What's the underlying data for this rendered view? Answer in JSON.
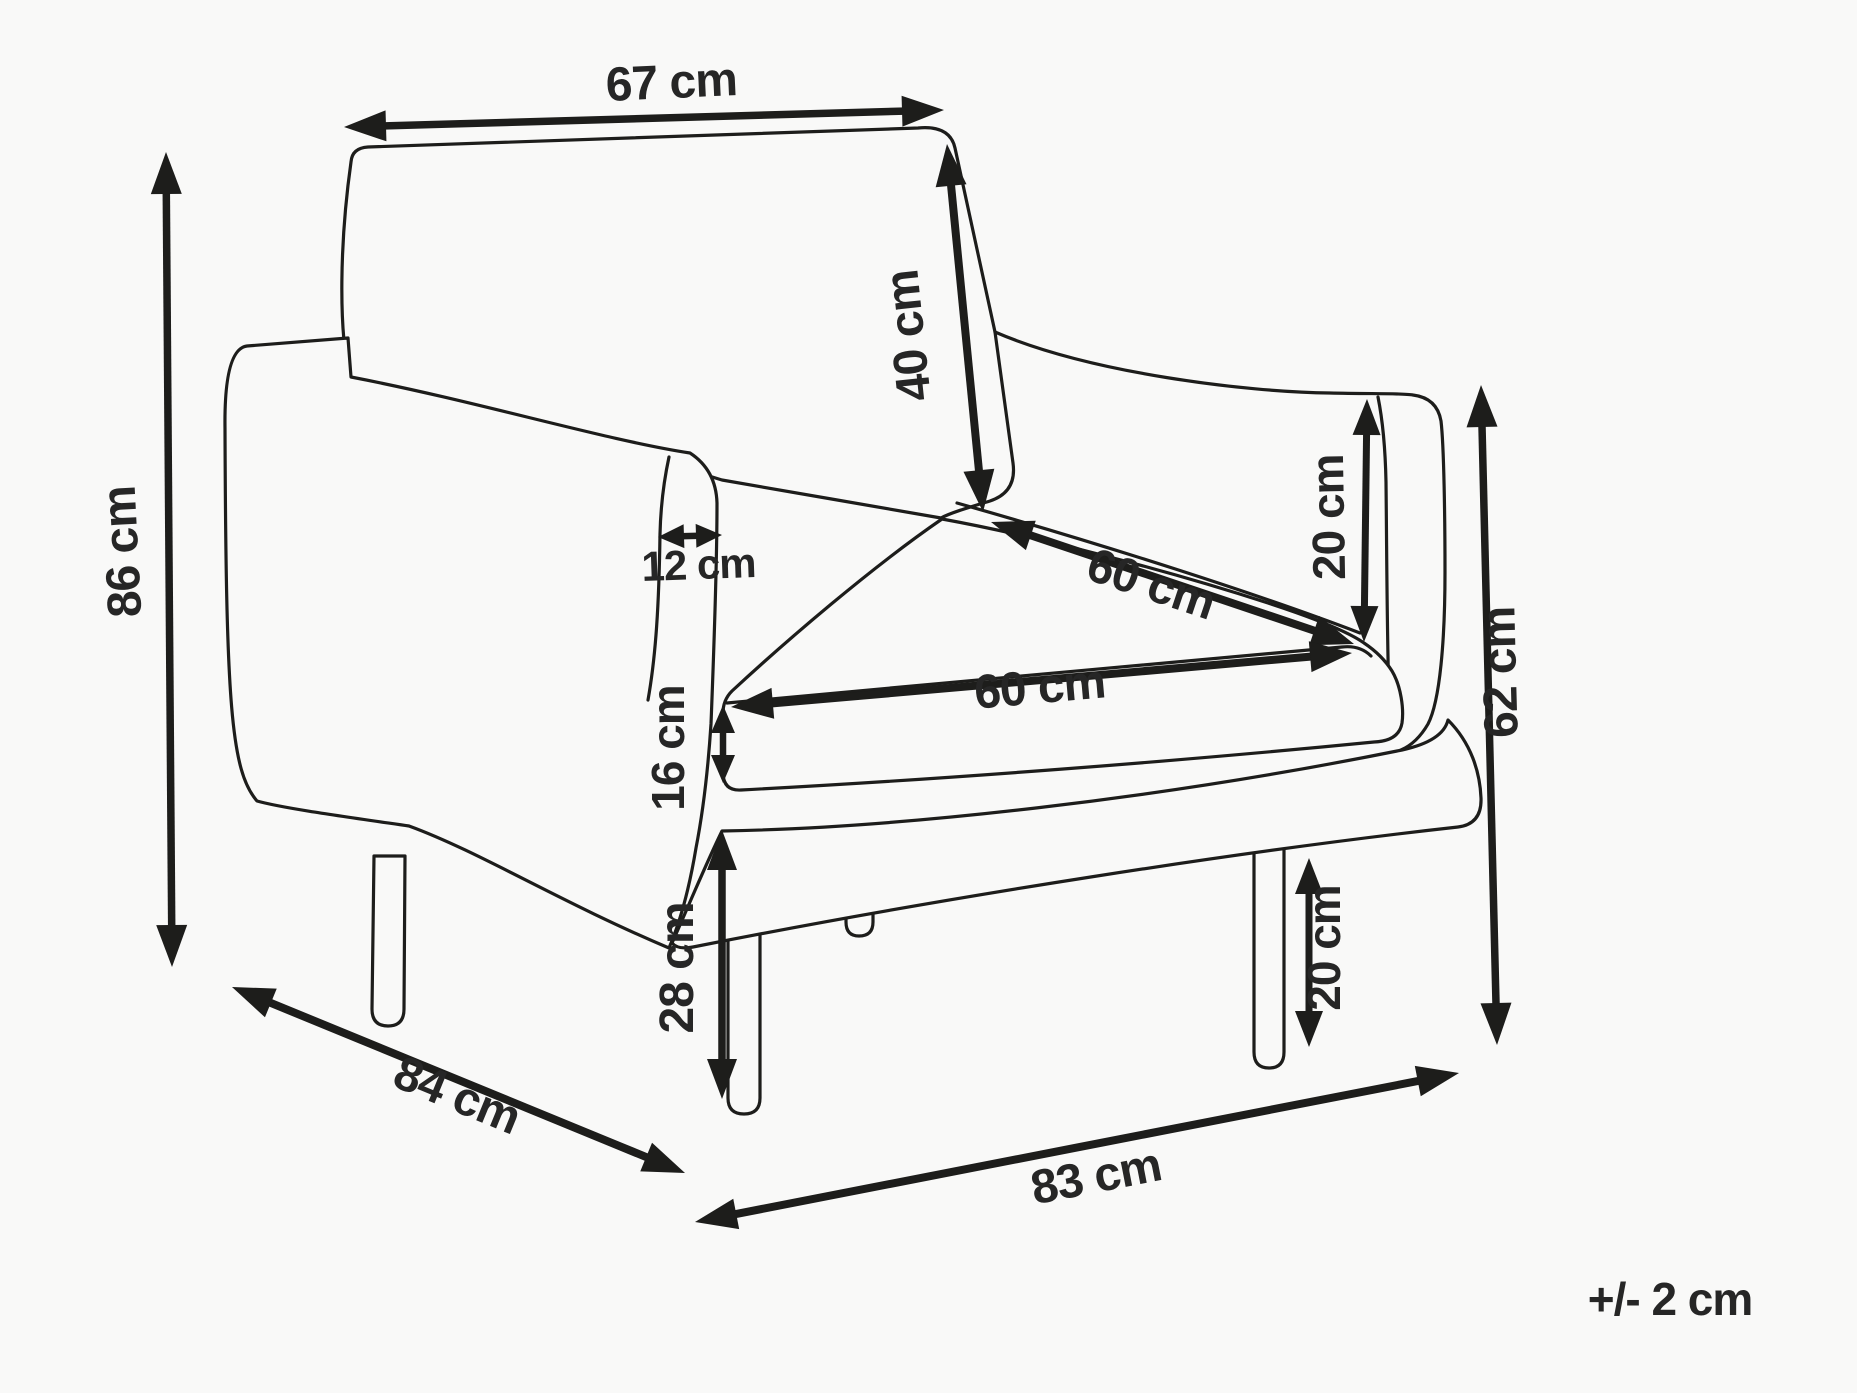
{
  "diagram": {
    "type": "furniture-dimension-diagram",
    "subject": "armchair",
    "unit": "cm",
    "colors": {
      "ink": "#1d1d1b",
      "background": "#f9f9f8",
      "label_text": "#262626"
    },
    "dimensions": {
      "back_width": {
        "label": "67 cm",
        "value": 67
      },
      "total_height": {
        "label": "86 cm",
        "value": 86
      },
      "backrest_height": {
        "label": "40 cm",
        "value": 40
      },
      "armrest_width": {
        "label": "12 cm",
        "value": 12
      },
      "seat_depth": {
        "label": "60 cm",
        "value": 60
      },
      "armrest_above_seat": {
        "label": "20 cm",
        "value": 20
      },
      "seat_width": {
        "label": "60 cm",
        "value": 60
      },
      "cushion_thickness": {
        "label": "16 cm",
        "value": 16
      },
      "side_height": {
        "label": "62 cm",
        "value": 62
      },
      "seat_height": {
        "label": "28 cm",
        "value": 28
      },
      "leg_height": {
        "label": "20 cm",
        "value": 20
      },
      "total_depth": {
        "label": "84 cm",
        "value": 84
      },
      "total_width": {
        "label": "83 cm",
        "value": 83
      }
    },
    "tolerance": {
      "label": "+/- 2 cm"
    }
  }
}
